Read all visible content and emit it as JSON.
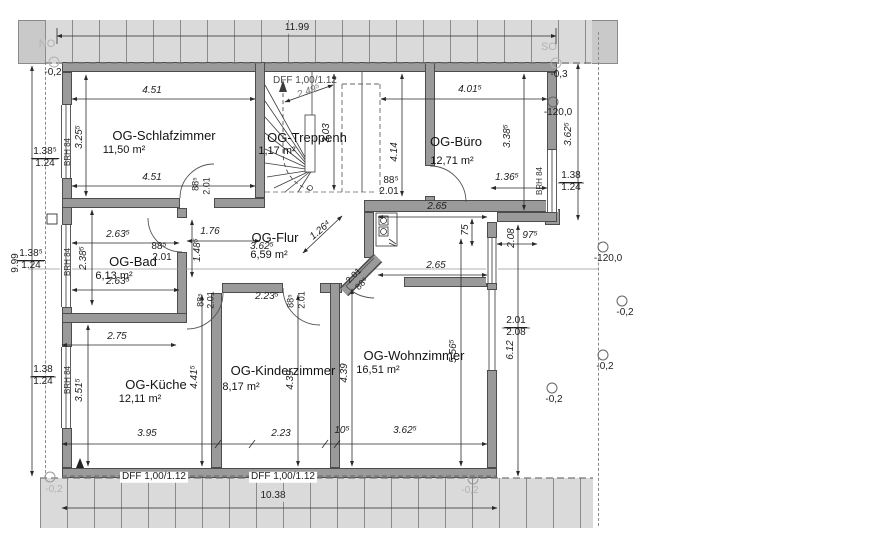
{
  "orientation": {
    "nw": "NO",
    "se": "SO"
  },
  "rooms": [
    {
      "name": "OG-Schlafzimmer",
      "area": "11,50 m²"
    },
    {
      "name": "OG-Treppenh",
      "area": "1,17 m²"
    },
    {
      "name": "OG-Büro",
      "area": "12,71 m²"
    },
    {
      "name": "OG-Flur",
      "area": "6,59 m²"
    },
    {
      "name": "OG-Bad",
      "area": "6,13 m²"
    },
    {
      "name": "OG-Küche",
      "area": "12,11 m²"
    },
    {
      "name": "OG-Kinderzimmer",
      "area": "8,17 m²"
    },
    {
      "name": "OG-Wohnzimmer",
      "area": "16,51 m²"
    }
  ],
  "dims": {
    "total_top": "11.99",
    "total_bottom": "10.38",
    "total_left": "9.99",
    "schlaf_top": "4.51",
    "schlaf_bottom": "4.51",
    "schlaf_h": "3.25⁵",
    "stair_diag": "2.49⁵",
    "stair_h": "3.03",
    "dff_roof": "DFF 1,00/1.12",
    "buero_top": "4.01⁵",
    "buero_h": "3.38⁵",
    "buero_entry": "4.14",
    "right_out": "3.62⁵",
    "buero_win": "1.36⁵",
    "nook_w1": "2.65",
    "nook_w2": "2.65",
    "nook_d": "75",
    "nook_small": "97⁵",
    "nook_v": "2.08",
    "flur_w": "1.76",
    "flur_diag": "1.26⁴",
    "flur_v": "1.48⁵",
    "flur_hidden": "3.62⁵",
    "bad_w1": "2.63⁵",
    "bad_w2": "2.63⁵",
    "bad_v": "2.38⁵",
    "kueche_top": "2.75",
    "kueche_v": "3.51⁵",
    "kueche_in": "4.41⁵",
    "kueche_dff": "3.95",
    "kinder_dff": "2.23",
    "kinder_v": "4.39",
    "kinder_door": "2.23⁵",
    "wohn_v": "4.39",
    "wohn_in": "5.56⁵",
    "wohn_right": "6.12",
    "wohn_bottom": "3.62⁵",
    "wall": "10⁵",
    "door_w": "88⁵",
    "door_h": "2.01",
    "win_a": "1.38⁵",
    "win_b": "1.38",
    "win_sill": "1.24",
    "win_wohn_t": "2.01",
    "win_wohn_b": "2.08",
    "brh": "BRH 84"
  },
  "levels": {
    "m02": "-0,2",
    "m03": "-0,3",
    "m120": "-120,0"
  }
}
